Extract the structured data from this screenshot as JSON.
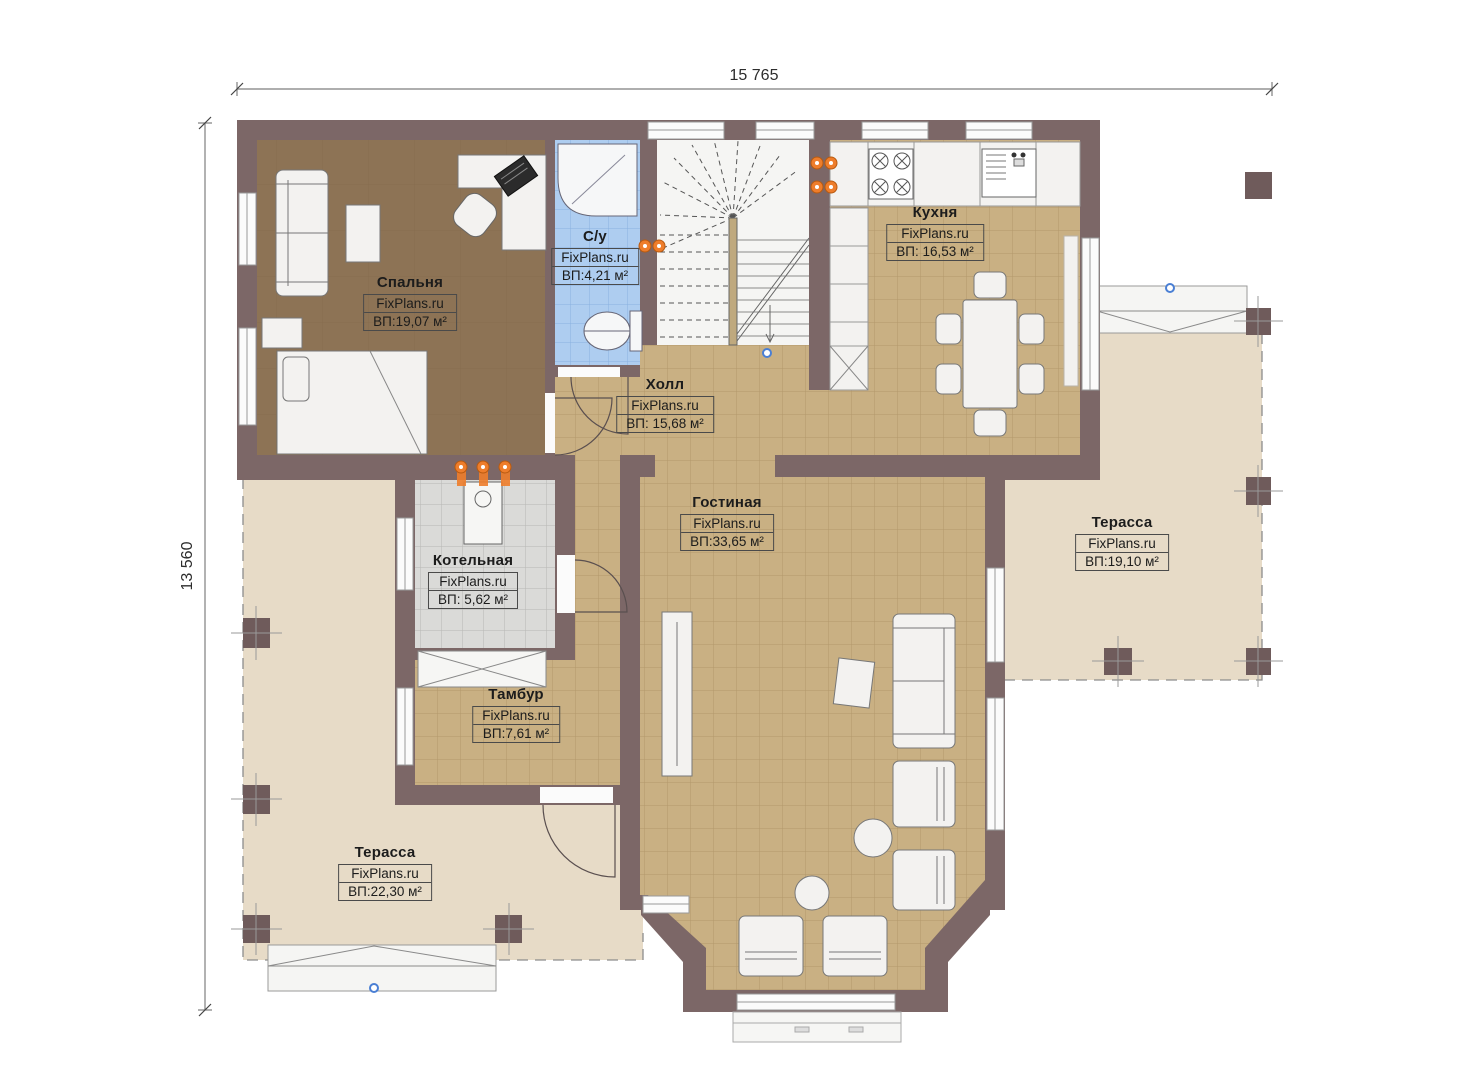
{
  "dimensions": {
    "width_label": "15 765",
    "height_label": "13 560"
  },
  "watermark": "FixPlans.ru",
  "rooms": {
    "bedroom": {
      "name": "Спальня",
      "brand": "FixPlans.ru",
      "area": "ВП:19,07 м²"
    },
    "bathroom": {
      "name": "С/у",
      "brand": "FixPlans.ru",
      "area": "ВП:4,21 м²"
    },
    "kitchen": {
      "name": "Кухня",
      "brand": "FixPlans.ru",
      "area": "ВП: 16,53 м²"
    },
    "hall": {
      "name": "Холл",
      "brand": "FixPlans.ru",
      "area": "ВП: 15,68 м²"
    },
    "living": {
      "name": "Гостиная",
      "brand": "FixPlans.ru",
      "area": "ВП:33,65 м²"
    },
    "boiler": {
      "name": "Котельная",
      "brand": "FixPlans.ru",
      "area": "ВП: 5,62 м²"
    },
    "vestibule": {
      "name": "Тамбур",
      "brand": "FixPlans.ru",
      "area": "ВП:7,61 м²"
    },
    "terrace_right": {
      "name": "Терасса",
      "brand": "FixPlans.ru",
      "area": "ВП:19,10 м²"
    },
    "terrace_left": {
      "name": "Терасса",
      "brand": "FixPlans.ru",
      "area": "ВП:22,30 м²"
    }
  },
  "colors": {
    "wall": "#7c6767",
    "floor_tile": "#c9b083",
    "floor_wood": "#8d7355",
    "floor_bath": "#aecdf0",
    "floor_boiler": "#dadad8",
    "terrace": "#e7dbc7",
    "accent_orange": "#ee7d2b",
    "accent_blue": "#4a7fd4"
  }
}
